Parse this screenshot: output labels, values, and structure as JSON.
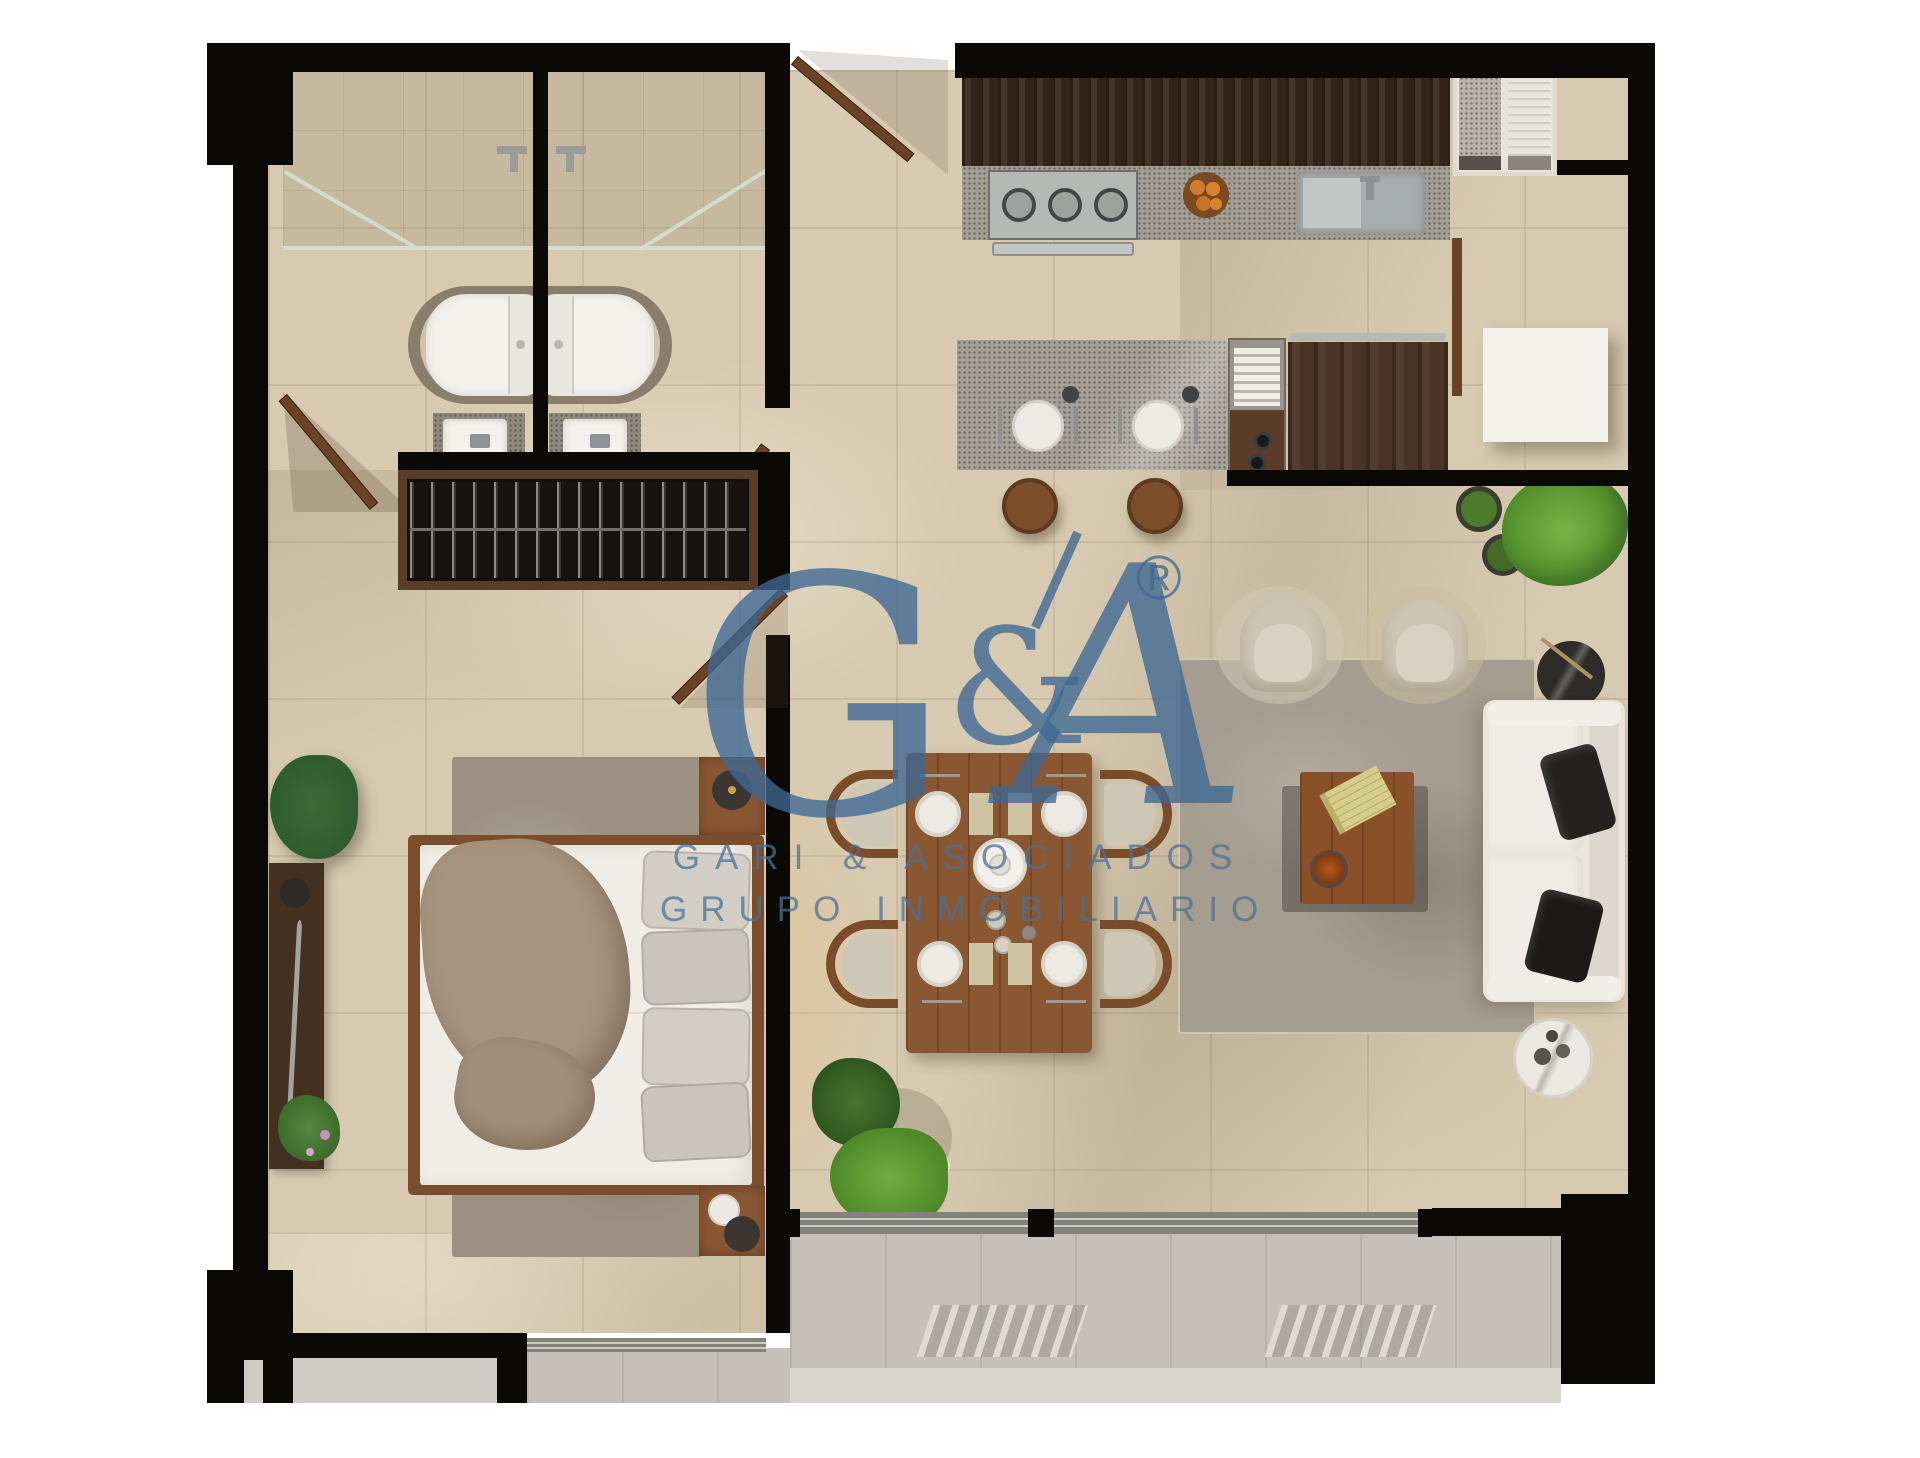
{
  "watermark": {
    "logo_g": "G",
    "logo_amp": "&",
    "logo_a": "A",
    "registered": "®",
    "line1": "GARI & ASOCIADOS",
    "line2": "GRUPO INMOBILIARIO",
    "color": "#3d6894"
  },
  "palette": {
    "background": "#ffffff",
    "wall": "#0b0906",
    "floor_tile": "#d7cab0",
    "deck": "#c5c1b8",
    "granite": "#a39e94",
    "wood_dark": "#3a2a1c",
    "wood_mid": "#8a5733",
    "door_wood": "#6b4226",
    "rug_living": "#a59d90",
    "rug_bedroom": "#9c9180",
    "sofa": "#e9e5dd",
    "armchair": "#cdc5b2",
    "pillow_black": "#22211f",
    "plant_green": "#69a93c",
    "plant_dark_green": "#2f5c30",
    "watermark_blue": "#3d6894"
  }
}
